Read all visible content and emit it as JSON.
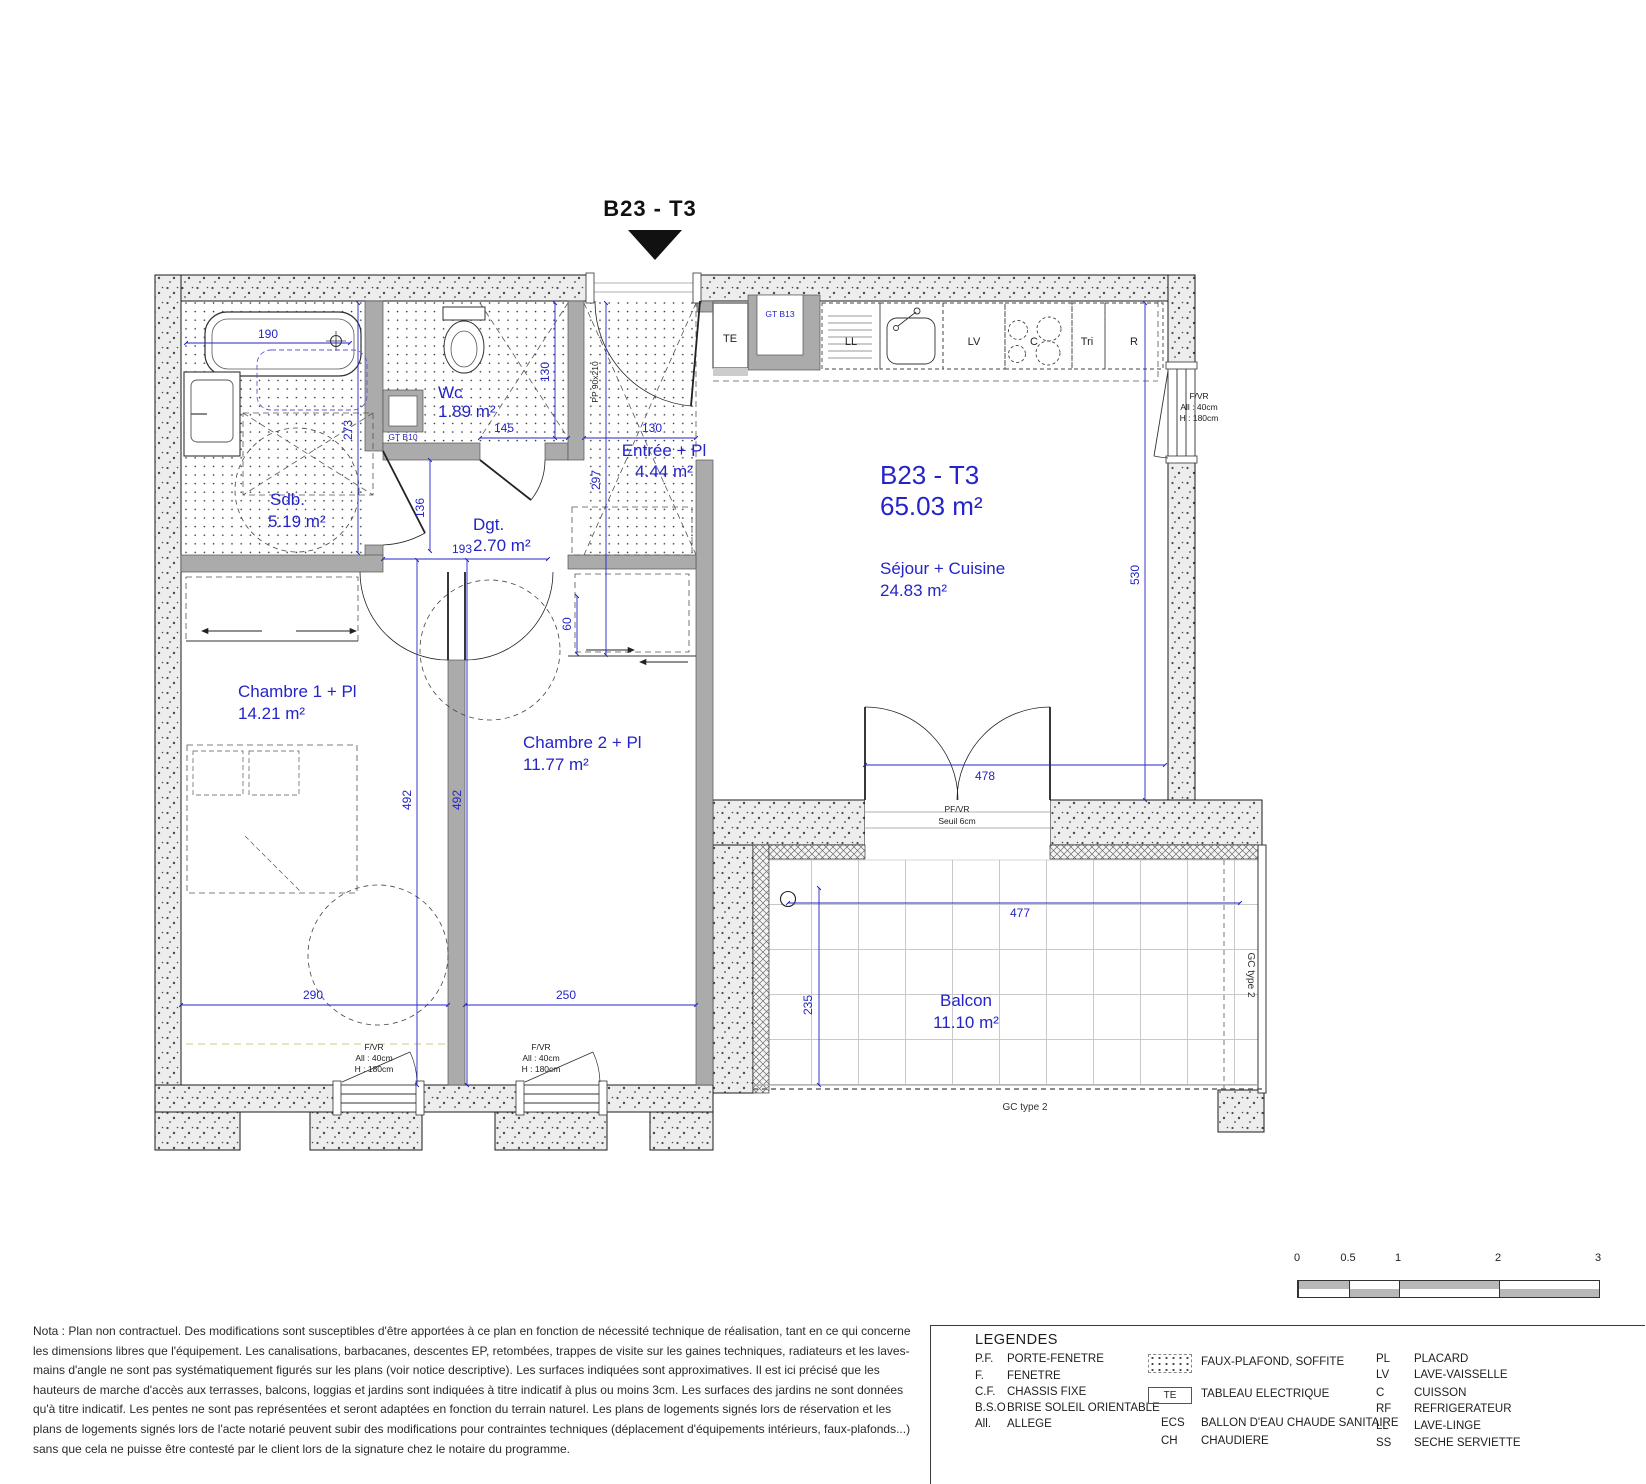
{
  "title": {
    "label": "B23 - T3"
  },
  "plan": {
    "unit": {
      "code": "B23 - T3",
      "area": "65.03 m²"
    },
    "rooms": {
      "sdb": {
        "name": "Sdb.",
        "area": "5.19 m²"
      },
      "wc": {
        "name": "Wc",
        "area": "1.89 m²"
      },
      "entree": {
        "name": "Entrée + Pl",
        "area": "4.44 m²"
      },
      "dgt": {
        "name": "Dgt.",
        "area": "2.70 m²"
      },
      "sejour": {
        "name": "Séjour + Cuisine",
        "area": "24.83 m²"
      },
      "chambre1": {
        "name": "Chambre 1 + Pl",
        "area": "14.21 m²"
      },
      "chambre2": {
        "name": "Chambre 2 + Pl",
        "area": "11.77 m²"
      },
      "balcon": {
        "name": "Balcon",
        "area": "11.10 m²"
      }
    },
    "dims": {
      "tub_width": "190",
      "sdb_height": "273",
      "dgt_height": "136",
      "dgt_width": "193",
      "wc_height": "130",
      "wc_width": "145",
      "entree_width": "130",
      "entree_height": "297",
      "closet_depth": "60",
      "chambre1_height": "492",
      "chambre2_height": "492",
      "chambre1_width": "290",
      "chambre2_width": "250",
      "sejour_height": "530",
      "bay_width": "478",
      "balcon_width": "477",
      "balcon_depth": "235"
    },
    "kitchen": {
      "te": "TE",
      "ll": "LL",
      "lv": "LV",
      "c": "C",
      "tri": "Tri",
      "r": "R"
    },
    "ducts": {
      "gt_b13": "GT B13",
      "gt_b10": "GT B10"
    },
    "window_note": {
      "type": "F/VR",
      "allege": "All : 40cm",
      "height": "H : 180cm"
    },
    "bay_note": {
      "type": "PF/VR",
      "seuil": "Seuil 6cm"
    },
    "entry_door_tag": "PP 90x210",
    "gc_label": "GC type 2"
  },
  "legend": {
    "title": "LEGENDES",
    "col1": [
      {
        "abbr": "P.F.",
        "label": "PORTE-FENETRE"
      },
      {
        "abbr": "F.",
        "label": "FENETRE"
      },
      {
        "abbr": "C.F.",
        "label": "CHASSIS FIXE"
      },
      {
        "abbr": "B.S.O",
        "label": "BRISE SOLEIL ORIENTABLE"
      },
      {
        "abbr": "All.",
        "label": "ALLEGE"
      }
    ],
    "col2": [
      {
        "swatch": "dots",
        "label": "FAUX-PLAFOND, SOFFITE"
      },
      {
        "swatch": "te",
        "swatch_label": "TE",
        "label": "TABLEAU ELECTRIQUE"
      },
      {
        "abbr": "ECS",
        "label": "BALLON D'EAU CHAUDE SANITAIRE"
      },
      {
        "abbr": "CH",
        "label": "CHAUDIERE"
      }
    ],
    "col3": [
      {
        "abbr": "PL",
        "label": "PLACARD"
      },
      {
        "abbr": "LV",
        "label": "LAVE-VAISSELLE"
      },
      {
        "abbr": "C",
        "label": "CUISSON"
      },
      {
        "abbr": "RF",
        "label": "REFRIGERATEUR"
      },
      {
        "abbr": "LL",
        "label": "LAVE-LINGE"
      },
      {
        "abbr": "SS",
        "label": "SECHE SERVIETTE"
      }
    ]
  },
  "nota": "Nota : Plan non contractuel. Des modifications sont susceptibles d'être apportées à ce plan en fonction de nécessité technique de réalisation, tant en ce qui concerne les dimensions libres que l'équipement. Les canalisations, barbacanes, descentes EP, retombées, trappes de visite sur les gaines techniques, radiateurs et les laves-mains d'angle ne sont pas systématiquement figurés sur les plans (voir notice descriptive). Les surfaces indiquées sont approximatives. Il est ici précisé que les hauteurs de marche d'accès aux terrasses, balcons, loggias et jardins sont indiquées à titre indicatif à plus ou moins 3cm. Les surfaces des jardins ne sont données qu'à titre indicatif. Les pentes ne sont pas représentées et seront adaptées en fonction du terrain naturel. Les plans de logements signés lors de réservation et les plans de logements signés lors de l'acte notarié peuvent subir des modifications pour contraintes techniques (déplacement d'équipements intérieurs, faux-plafonds...) sans que cela ne puisse être contesté par le client lors de la signature chez le notaire du programme.",
  "scalebar": {
    "labels": [
      "0",
      "0.5",
      "1",
      "2",
      "3"
    ]
  },
  "colors": {
    "annotation_blue": "#2424c8",
    "wall_fill": "#ededed",
    "partition_gray": "#ababab"
  }
}
